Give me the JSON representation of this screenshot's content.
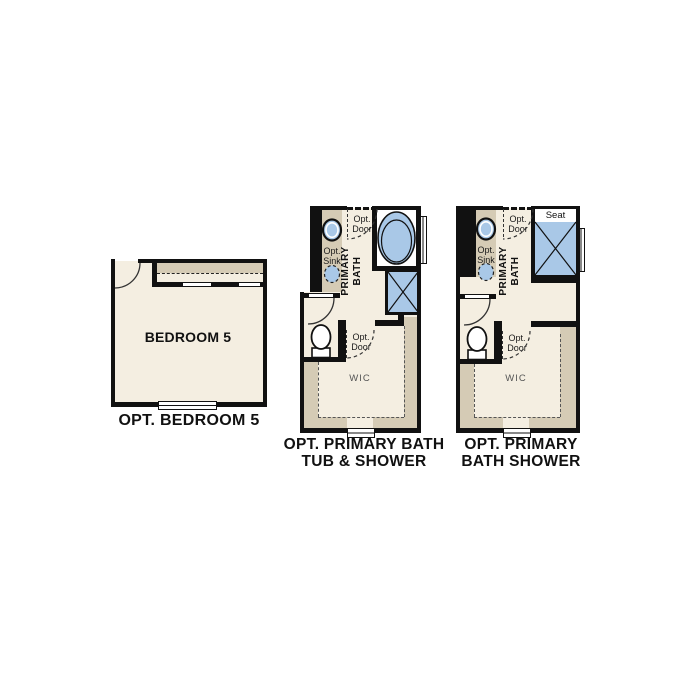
{
  "colors": {
    "wall": "#111111",
    "floor": "#f4eee1",
    "shelf_tan": "#d5cbb5",
    "fixture_blue": "#a9c8e7",
    "wic_text": "#555555"
  },
  "bedroom": {
    "room_label": "BEDROOM 5",
    "caption": "OPT. BEDROOM 5"
  },
  "bath_tub": {
    "labels": {
      "opt_door_top": "Opt.\nDoor",
      "opt_sink": "Opt.\nSink",
      "primary_bath": "PRIMARY\nBATH",
      "opt_door_mid": "Opt.\nDoor",
      "wic": "WIC"
    },
    "caption_line1": "OPT. PRIMARY BATH",
    "caption_line2": "TUB & SHOWER"
  },
  "bath_shower": {
    "labels": {
      "opt_door_top": "Opt.\nDoor",
      "opt_sink": "Opt.\nSink",
      "primary_bath": "PRIMARY\nBATH",
      "seat": "Seat",
      "opt_door_mid": "Opt.\nDoor",
      "wic": "WIC"
    },
    "caption_line1": "OPT. PRIMARY",
    "caption_line2": "BATH SHOWER"
  }
}
